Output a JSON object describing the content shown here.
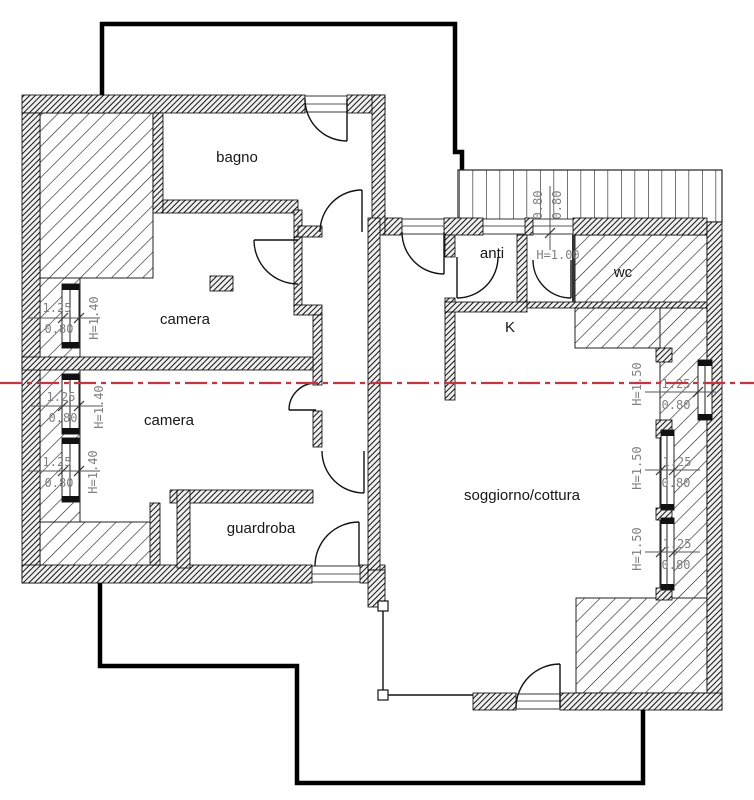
{
  "title": "attic apartment floor plan",
  "labels": {
    "bagno": "bagno",
    "camera_1": "camera",
    "camera_2": "camera",
    "guardroba": "guardroba",
    "anti": "anti",
    "wc": "wc",
    "kitchen": "K",
    "soggiorno": "soggiorno/cottura",
    "passage_height": "H=1.00"
  },
  "windows_left": [
    {
      "width": "1.25",
      "parapet": "0.80",
      "height": "H=1.40"
    },
    {
      "width": "1.25",
      "parapet": "0.80",
      "height": "H=1.40"
    },
    {
      "width": "1.25",
      "parapet": "0.80",
      "height": "H=1.40"
    }
  ],
  "windows_right": [
    {
      "width": "1.25",
      "parapet": "0.80",
      "height": "H=1.50"
    },
    {
      "width": "1.25",
      "parapet": "0.80",
      "height": "H=1.50"
    },
    {
      "width": "1.25",
      "parapet": "0.80",
      "height": "H=1.50"
    }
  ],
  "top_dims": {
    "left": "0.80",
    "right": "0.80"
  },
  "colors": {
    "section_line": "#c43542",
    "wall": "#111111",
    "dim_text": "#7f7f7f"
  }
}
